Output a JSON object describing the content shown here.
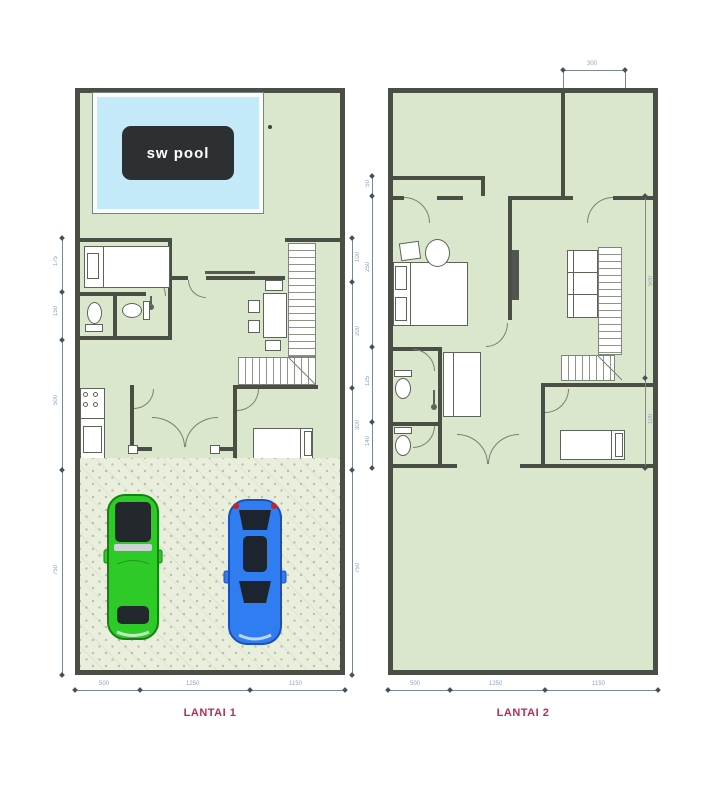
{
  "pool": {
    "label": "sw pool"
  },
  "floor1": {
    "label": "LANTAI 1"
  },
  "floor2": {
    "label": "LANTAI 2"
  },
  "dims": {
    "f1_left": [
      "175",
      "150",
      "500",
      "750"
    ],
    "f1_right": [
      "100",
      "200",
      "300",
      "750"
    ],
    "f1_bottom": [
      "500",
      "1250",
      "1150"
    ],
    "f2_top": [
      "300"
    ],
    "f2_left": [
      "50",
      "250",
      "125",
      "140"
    ],
    "f2_right": [
      "500",
      "100"
    ],
    "f2_bottom": [
      "500",
      "1250",
      "1150"
    ]
  },
  "colors": {
    "wall": "#4a4f46",
    "floor": "#dbe7cd",
    "garage": "#e9efdc",
    "water": "#c4e9f8",
    "poolbox": "#2c3033",
    "accent": "#b92b4e",
    "car-green": "#2ecb28",
    "car-blue": "#2f7df0",
    "dim": "#8fa0ca"
  }
}
